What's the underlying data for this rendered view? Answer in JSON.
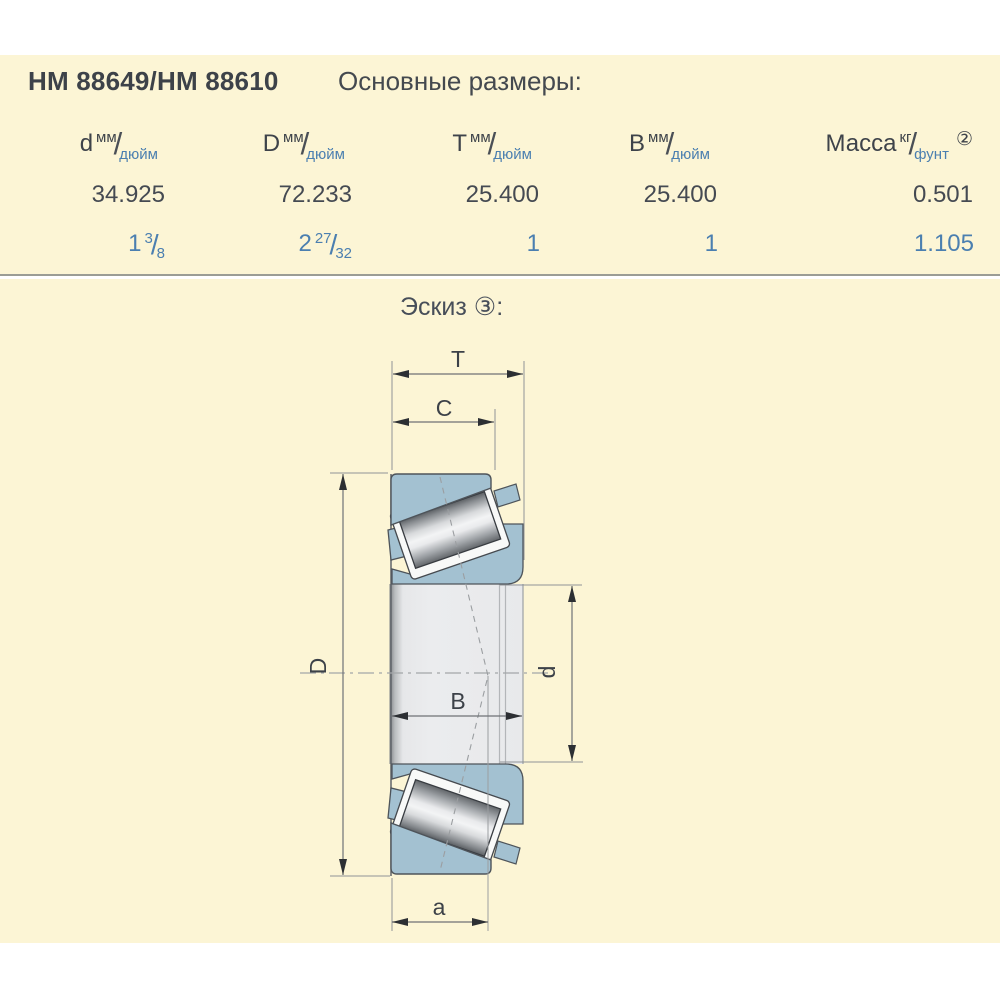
{
  "page": {
    "title": "HM 88649/HM 88610",
    "subtitle": "Основные размеры:"
  },
  "table": {
    "columns": [
      {
        "symbol": "d",
        "top_unit": "мм",
        "slash": "/",
        "bottom_unit": "дюйм",
        "note": ""
      },
      {
        "symbol": "D",
        "top_unit": "мм",
        "slash": "/",
        "bottom_unit": "дюйм",
        "note": ""
      },
      {
        "symbol": "T",
        "top_unit": "мм",
        "slash": "/",
        "bottom_unit": "дюйм",
        "note": ""
      },
      {
        "symbol": "B",
        "top_unit": "мм",
        "slash": "/",
        "bottom_unit": "дюйм",
        "note": ""
      },
      {
        "symbol": "Масса",
        "top_unit": "кг",
        "slash": "/",
        "bottom_unit": "фунт",
        "note": "②"
      }
    ],
    "row_mm": [
      "34.925",
      "72.233",
      "25.400",
      "25.400",
      "0.501"
    ],
    "row_inch": [
      {
        "whole": "1",
        "num": "3",
        "slash": "/",
        "den": "8"
      },
      {
        "whole": "2",
        "num": "27",
        "slash": "/",
        "den": "32"
      },
      {
        "whole": "1",
        "num": "",
        "slash": "",
        "den": ""
      },
      {
        "whole": "1",
        "num": "",
        "slash": "",
        "den": ""
      },
      {
        "whole": "1.105",
        "num": "",
        "slash": "",
        "den": ""
      }
    ]
  },
  "sketch": {
    "title": "Эскиз ③:",
    "labels": {
      "T": "T",
      "C": "C",
      "B": "B",
      "a": "a",
      "D": "D",
      "d": "d"
    }
  },
  "colors": {
    "background_cream": "#fcf5d5",
    "text_dark": "#41464d",
    "text_blue": "#4b7fb0",
    "bearing_ring_fill": "#a3c1d1",
    "divider_gray": "#9b9d95"
  }
}
